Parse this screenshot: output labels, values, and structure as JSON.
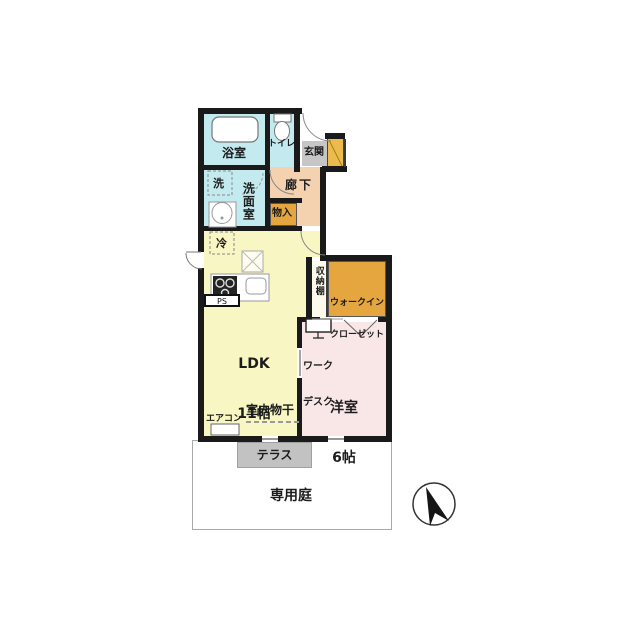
{
  "floorplan": {
    "rooms": {
      "bathroom": "浴室",
      "toilet": "トイレ",
      "entrance": "玄関",
      "hallway": "廊下",
      "laundry": "洗",
      "washroom": "洗面室",
      "storage": "物入",
      "fridge": "冷",
      "pipe_space": "PS",
      "ldk": "LDK",
      "ldk_size": "11帖",
      "shelf": "収納棚",
      "walk_in_closet_line1": "ウォークイン",
      "walk_in_closet_line2": "クローゼット",
      "work_desk_line1": "ワーク",
      "work_desk_line2": "デスク",
      "western_room": "洋室",
      "western_room_size": "6帖",
      "indoor_drying": "室内物干",
      "air_conditioner": "エアコン",
      "terrace": "テラス",
      "private_garden": "専用庭"
    },
    "colors": {
      "wet_area": "#c3ebef",
      "hallway_floor": "#f4d2b0",
      "closet": "#e5a53f",
      "ldk_floor": "#f8f6c3",
      "western_floor": "#f9e7e7",
      "terrace_floor": "#c2c2c2",
      "entrance_floor": "#c6c6c6",
      "front_door": "#edbb4d",
      "wall": "#1a1a1a"
    },
    "compass": {
      "icon": "north-arrow"
    }
  }
}
